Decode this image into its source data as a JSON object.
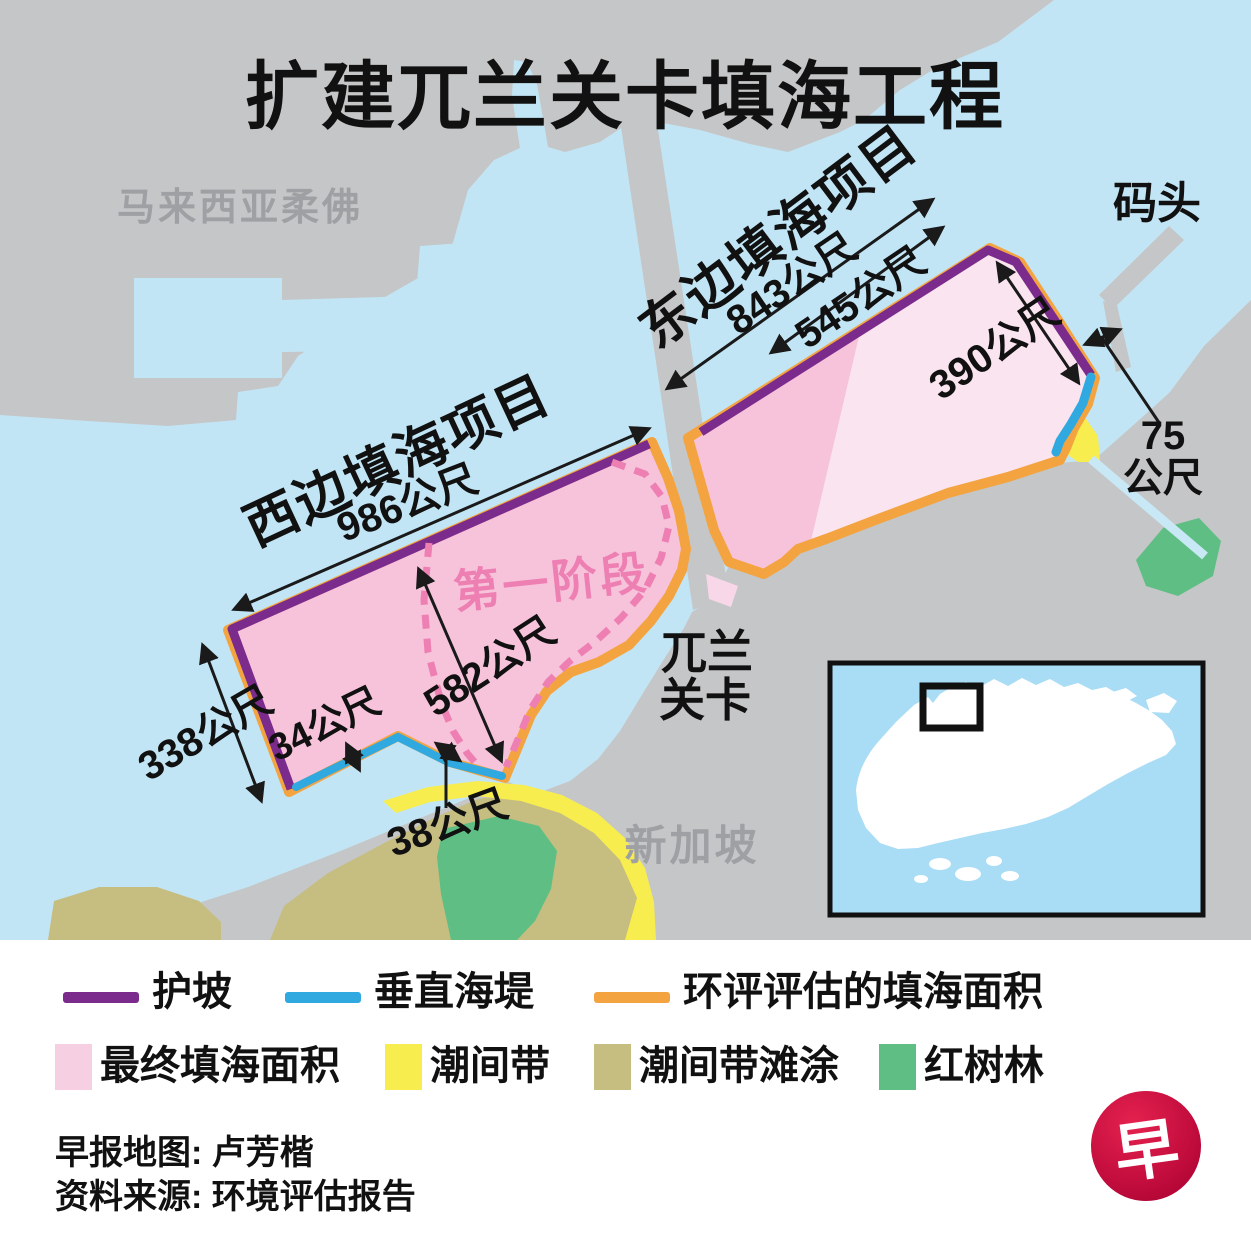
{
  "title": "扩建兀兰关卡填海工程",
  "map": {
    "labels": {
      "malaysia": "马来西亚柔佛",
      "pier": "码头",
      "west_project": "西边填海项目",
      "east_project": "东边填海项目",
      "phase1": "第一阶段",
      "checkpoint1": "兀兰",
      "checkpoint2": "关卡",
      "singapore": "新加坡"
    },
    "measurements": {
      "west_top": "986公尺",
      "west_left": "338公尺",
      "west_seawall": "34公尺",
      "west_phase": "582公尺",
      "west_gap": "38公尺",
      "east_outer": "843公尺",
      "east_inner": "545公尺",
      "east_right": "390公尺",
      "channel_value": "75",
      "channel_unit": "公尺"
    },
    "colors": {
      "water": "#C2E5F5",
      "land": "#C5C6C7",
      "revetment_purple": "#7B2B8B",
      "seawall_blue": "#2FA9E0",
      "eia_orange": "#F3A440",
      "reclaim_pink": "#F6C3DB",
      "reclaim_pink_light": "#FAE4F0",
      "intertidal_yellow": "#F8ED4E",
      "mudflat_khaki": "#C6BD81",
      "mangrove_green": "#5FBE83",
      "phase_dash_pink": "#EE7FB2",
      "inset_water": "#A9DCF5",
      "gray_text": "#9EA0A3",
      "logo_red": "#C40E3E"
    }
  },
  "legend": {
    "lines": [
      {
        "label": "护坡",
        "color": "#7B2B8B"
      },
      {
        "label": "垂直海堤",
        "color": "#2FA9E0"
      },
      {
        "label": "环评评估的填海面积",
        "color": "#F3A440"
      }
    ],
    "areas": [
      {
        "label": "最终填海面积",
        "color": "#F6CFE3"
      },
      {
        "label": "潮间带",
        "color": "#F8ED4E"
      },
      {
        "label": "潮间带滩涂",
        "color": "#C6BD81"
      },
      {
        "label": "红树林",
        "color": "#5FBE83"
      }
    ]
  },
  "credits": {
    "map_credit": "早报地图: 卢芳楷",
    "source": "资料来源: 环境评估报告",
    "logo_char": "早"
  }
}
